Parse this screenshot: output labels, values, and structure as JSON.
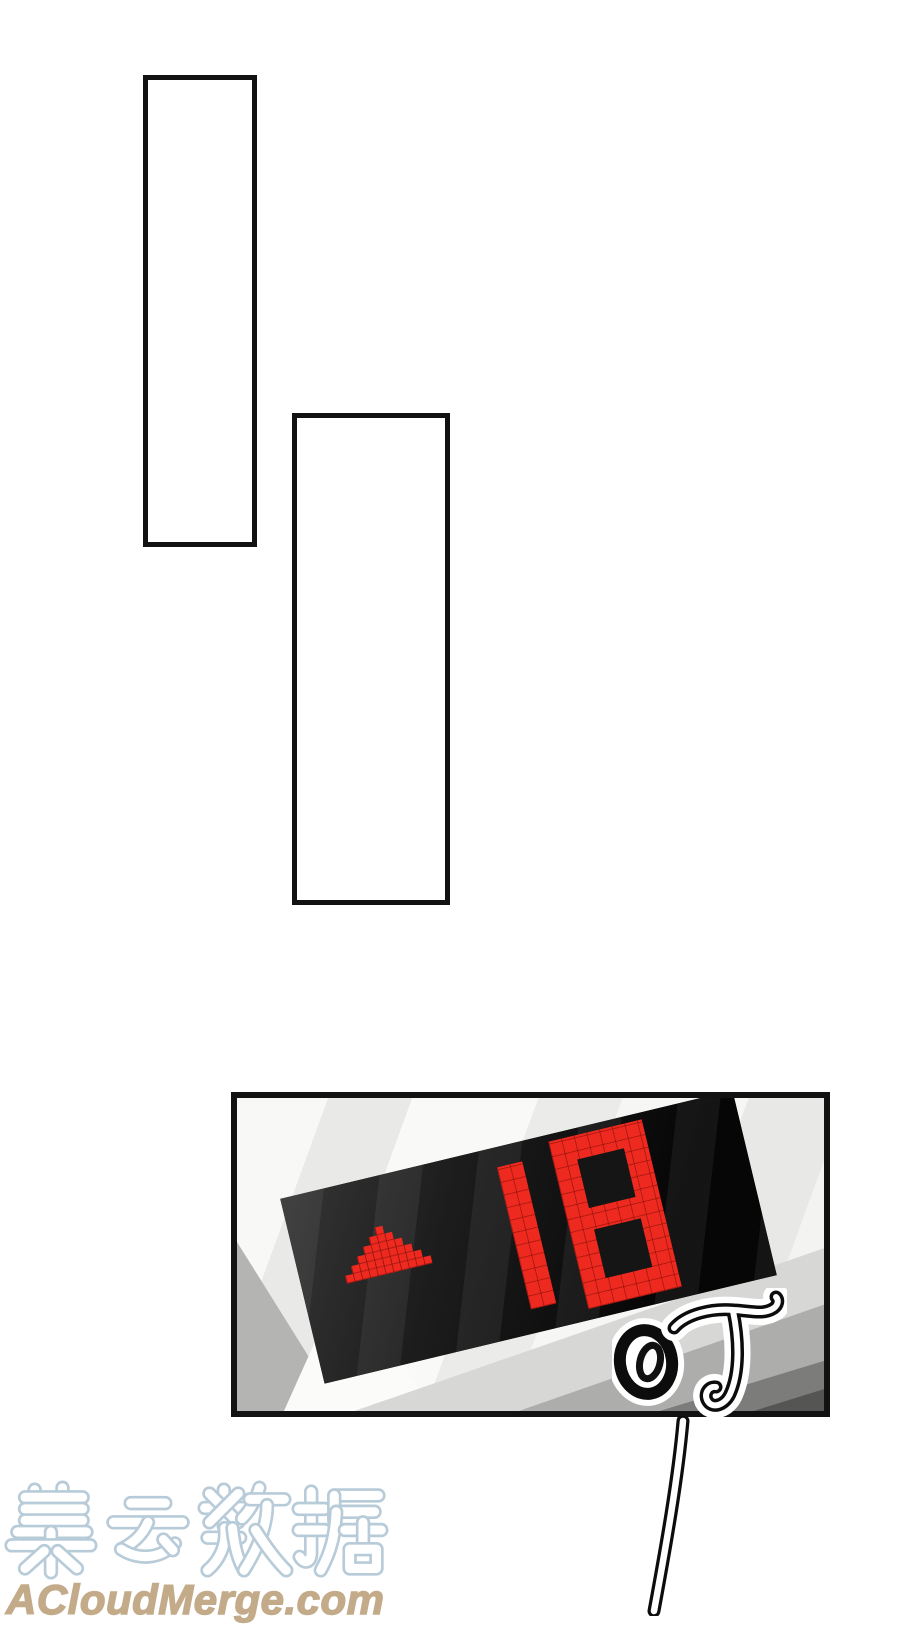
{
  "page_background": "#ffffff",
  "elevator_display": {
    "floor": "18",
    "direction": "up",
    "arrow_rows": [
      1,
      3,
      5,
      7,
      9,
      11
    ],
    "led_color": "#ee2a20",
    "screen_color": "#151515"
  },
  "sfx": {
    "text": "叮"
  },
  "watermark": {
    "brand": "集云数据",
    "url": "ACloudMerge.com",
    "outline_color": "#b7cbd8",
    "url_color": "#c3ab8a"
  },
  "colors": {
    "led": "#ee2a20",
    "screen": "#151515",
    "panel-border": "#121212",
    "wm-outline": "#b7cbd8",
    "wm-url": "#c3ab8a"
  }
}
